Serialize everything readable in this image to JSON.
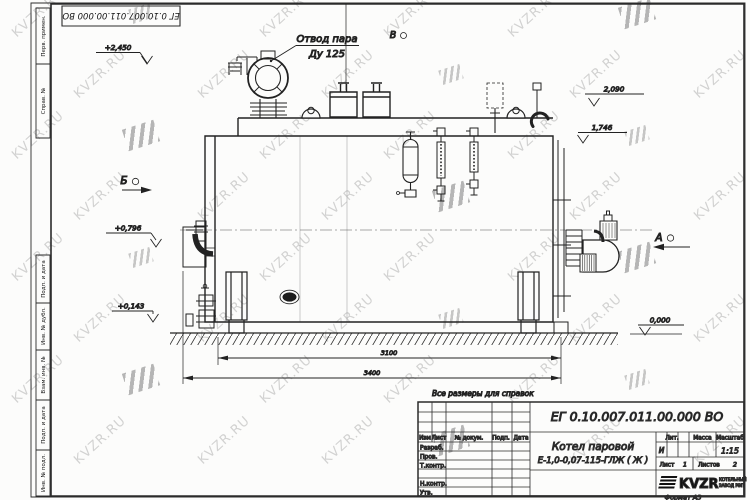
{
  "watermark": {
    "text": "KVZR.RU"
  },
  "corner_stamp": {
    "doc_number": "ЕГ 0.10.007.011.00.000  ВО"
  },
  "margin_labels": {
    "top": [
      "Перв. примен.",
      "Справ. №"
    ],
    "bottom": [
      "Подп. и дата",
      "Инв. № дубл.",
      "Взам. инв. №",
      "Подп. и дата",
      "Инв. № подл."
    ]
  },
  "drawing": {
    "callout": {
      "line1": "Отвод пара",
      "line2": "Ду 125"
    },
    "views": {
      "b": "Б",
      "v": "В",
      "a": "А"
    },
    "elevations": [
      "+2,450",
      "2,090",
      "1,746",
      "+0,796",
      "+0,143",
      "0,000"
    ],
    "dimensions": [
      "3100",
      "3400"
    ],
    "note": "Все размеры для справок"
  },
  "title_block": {
    "doc_number": "ЕГ 0.10.007.011.00.000  ВО",
    "product_name_line1": "Котел паровой",
    "product_name_line2": "Е-1,0-0,07-115-ГЛЖ ( Ж )",
    "header_cols": [
      "Изм",
      "Лист",
      "№ докум.",
      "Подп.",
      "Дата"
    ],
    "row_labels": [
      "Разраб.",
      "Пров.",
      "Т.контр.",
      "Н.контр.",
      "Утв."
    ],
    "lit_label": "Лит.",
    "mass_label": "Масса",
    "scale_label": "Масштаб",
    "lit_value": "И",
    "scale_value": "1:15",
    "sheet_label": "Лист",
    "sheet_value": "1",
    "sheets_label": "Листов",
    "sheets_value": "2",
    "company": "KVZR",
    "company_sub1": "КОТЕЛЬНЫЙ",
    "company_sub2": "ЗАВОД РЭП",
    "format_label": "Формат А3"
  }
}
